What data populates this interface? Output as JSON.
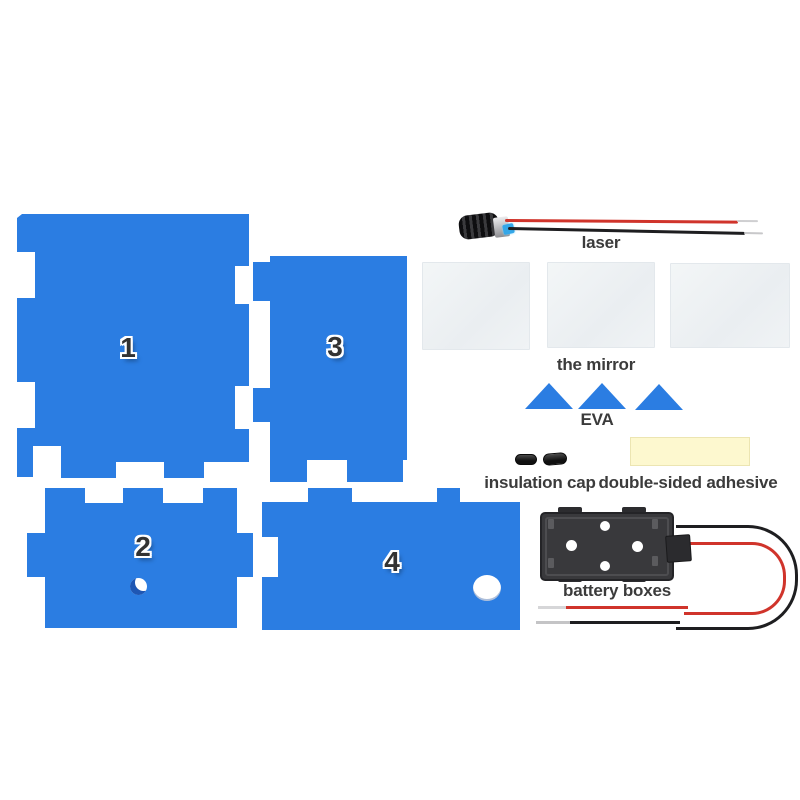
{
  "colors": {
    "panel_blue": "#2b7de2",
    "panel_shadow": "#1e57b4",
    "mirror_gray": "#eef1f4",
    "adhesive_yellow": "#fdf8cf",
    "battery_dark": "#39393c",
    "wire_red": "#d0342b",
    "wire_black": "#1e1e20"
  },
  "panels": [
    {
      "number": "1"
    },
    {
      "number": "2"
    },
    {
      "number": "3"
    },
    {
      "number": "4"
    }
  ],
  "labels": {
    "laser": "laser",
    "mirror": "the mirror",
    "eva": "EVA",
    "insulation_cap": "insulation cap",
    "adhesive": "double-sided adhesive",
    "battery": "battery boxes"
  }
}
